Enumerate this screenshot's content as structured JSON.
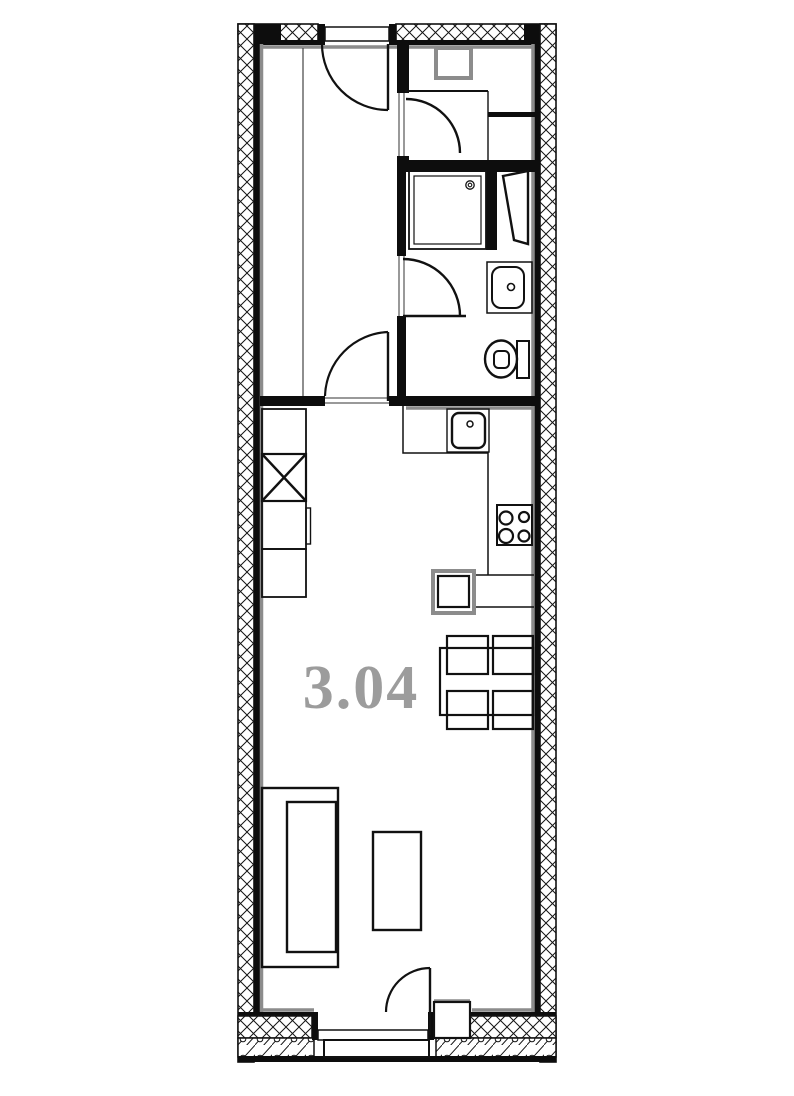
{
  "plan": {
    "unit_label": "3.04",
    "colors": {
      "wall_line": "#0d0d0d",
      "inner_face_gray": "#8c8c8c",
      "label": "#9c9c9c",
      "background": "#ffffff"
    },
    "legend": {
      "exterior_wall_hatch": "cross-hatch",
      "base_course_hatch": "diagonal-with-circles"
    },
    "elements": [
      "french-window",
      "bedroom",
      "entry-hall",
      "hall-wardrobe",
      "shower-tray",
      "utility-shaft",
      "washbasin",
      "toilet",
      "bathroom-door",
      "bedroom-door",
      "hall-door",
      "kitchen-counter",
      "kitchen-sink",
      "cooktop-4-burner",
      "tall-cabinet-column",
      "dishwasher",
      "dining-table",
      "dining-chairs-x4",
      "sofa",
      "coffee-table",
      "entrance-door",
      "entrance-step"
    ]
  }
}
